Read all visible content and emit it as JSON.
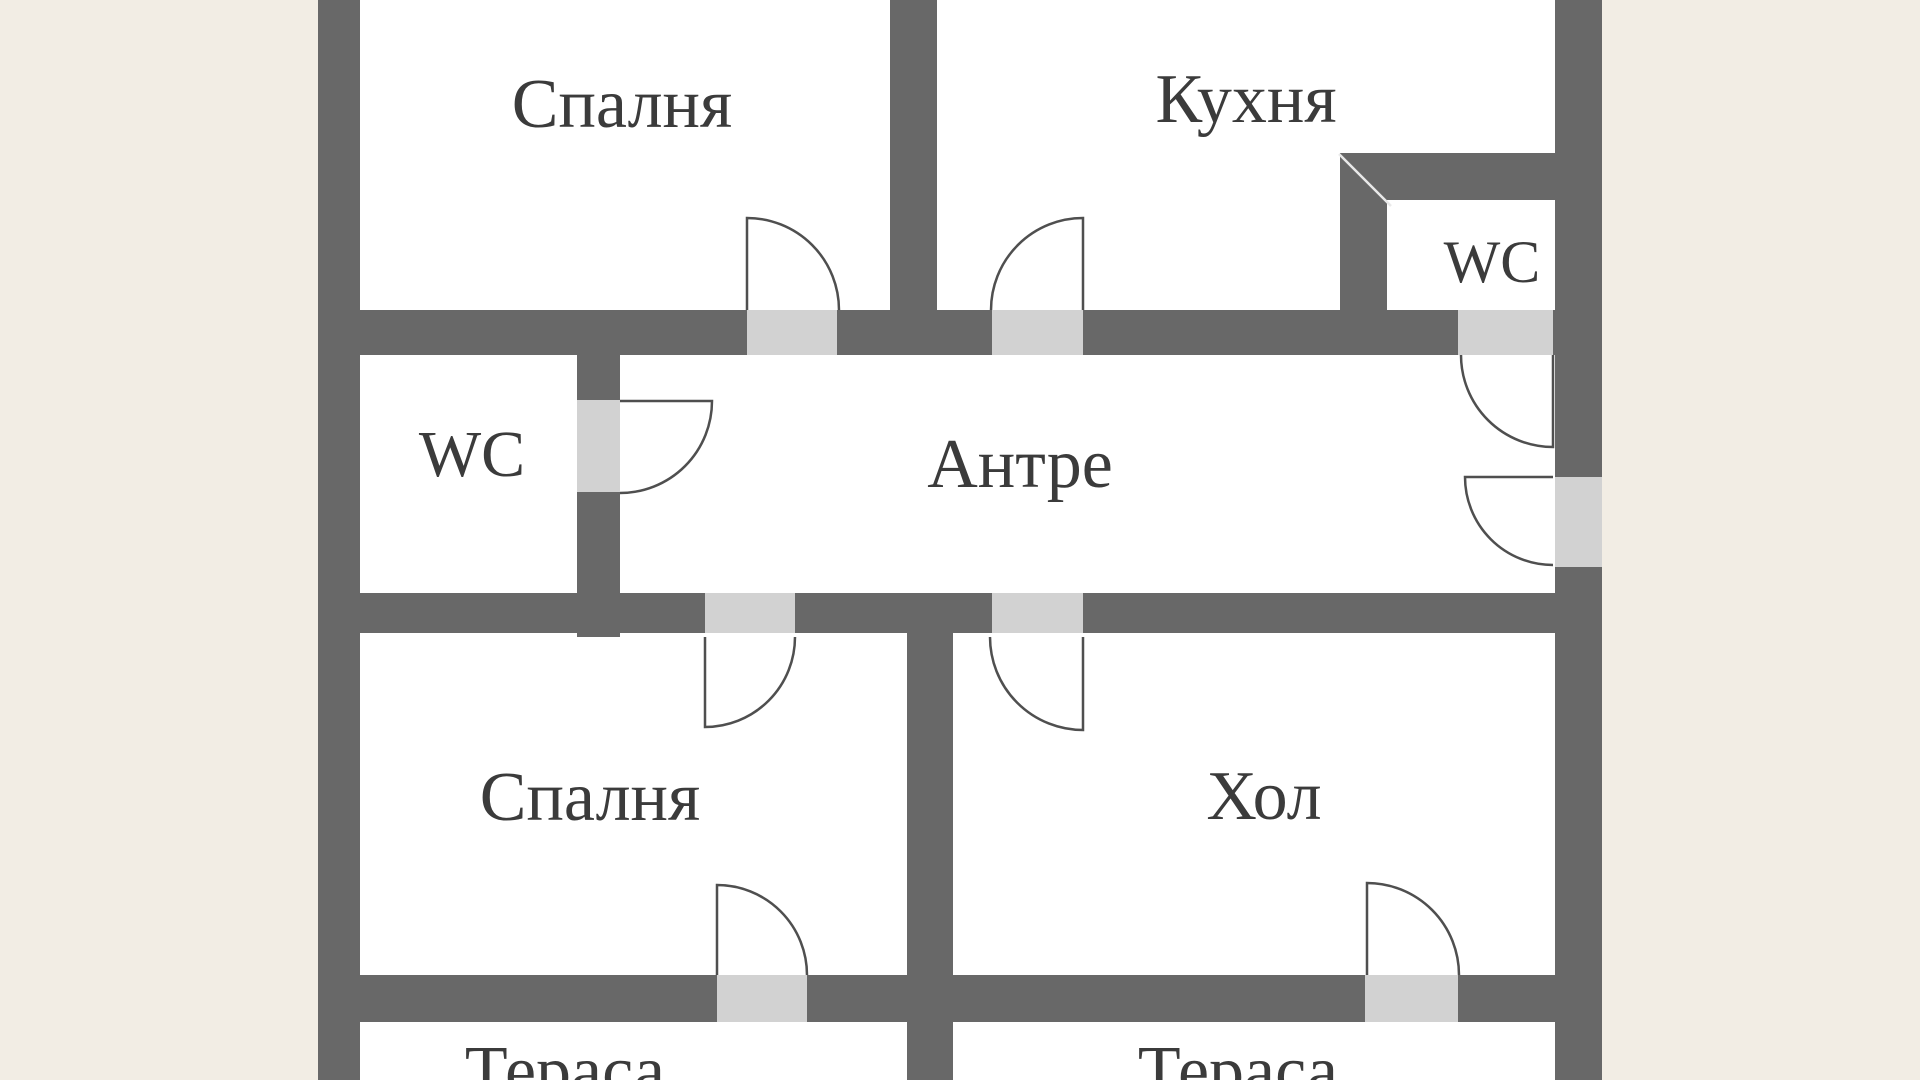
{
  "plan": {
    "type": "floor-plan",
    "rooms": [
      {
        "id": "bedroom-top",
        "label": "Спалня"
      },
      {
        "id": "kitchen",
        "label": "Кухня"
      },
      {
        "id": "wc-right",
        "label": "WC"
      },
      {
        "id": "wc-left",
        "label": "WC"
      },
      {
        "id": "hallway",
        "label": "Антре"
      },
      {
        "id": "bedroom-bottom",
        "label": "Спалня"
      },
      {
        "id": "living-room",
        "label": "Хол"
      },
      {
        "id": "terrace-left",
        "label": "Тераса"
      },
      {
        "id": "terrace-right",
        "label": "Тераса"
      }
    ],
    "doors": [
      "bedroom-top-door",
      "kitchen-door",
      "wc-right-door",
      "wc-left-door",
      "entrance-door",
      "bedroom-bottom-door",
      "living-room-door",
      "terrace-left-door",
      "terrace-right-door"
    ],
    "colors": {
      "outside_background": "#f2ede4",
      "floor": "#ffffff",
      "wall": "#686868",
      "door_opening": "#d2d2d2",
      "door_swing_stroke": "#4f4f4f",
      "label_text": "#3b3b3b"
    }
  }
}
